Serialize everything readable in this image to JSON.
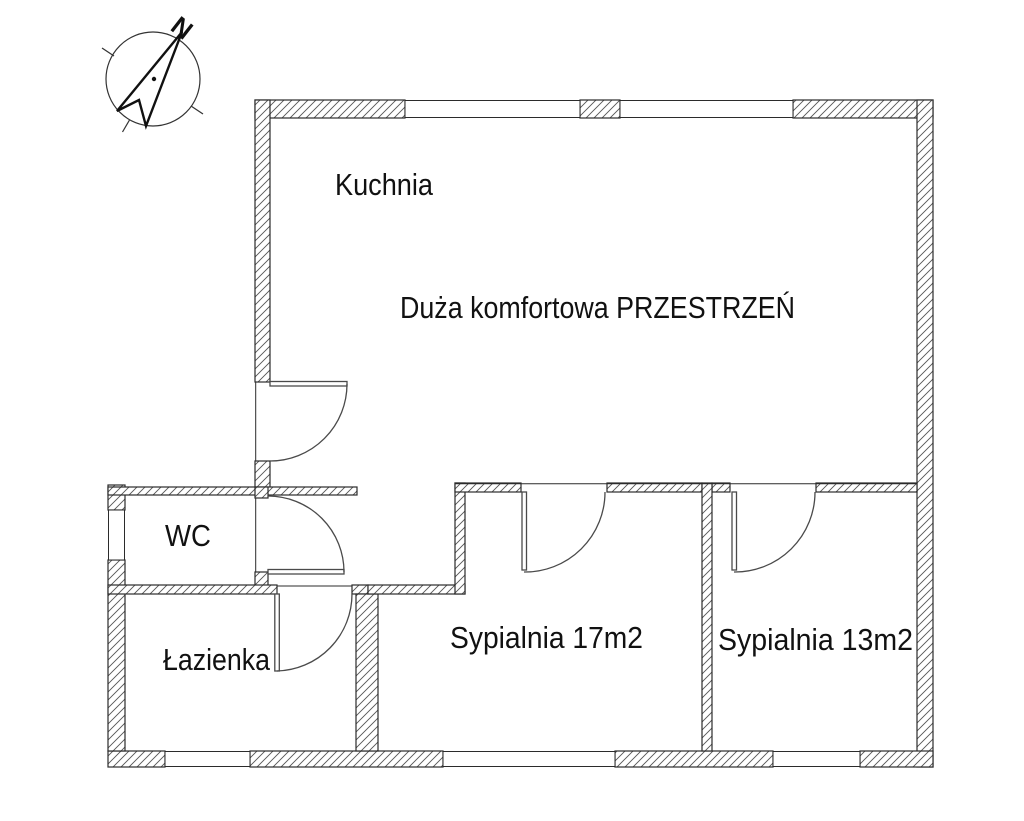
{
  "plan": {
    "rooms": {
      "kitchen": {
        "label": "Kuchnia"
      },
      "living_space": {
        "label": "Duża komfortowa PRZESTRZEŃ"
      },
      "wc": {
        "label": "WC"
      },
      "bathroom": {
        "label": "Łazienka"
      },
      "bedroom_large": {
        "label": "Sypialnia 17m2"
      },
      "bedroom_small": {
        "label": "Sypialnia 13m2"
      }
    },
    "compass": {
      "north_label": "N"
    }
  },
  "colors": {
    "background": "#ffffff",
    "wall_line": "#2b2b2b",
    "hatch_line": "#555555",
    "door_line": "#4a4a4a",
    "text": "#111111"
  }
}
